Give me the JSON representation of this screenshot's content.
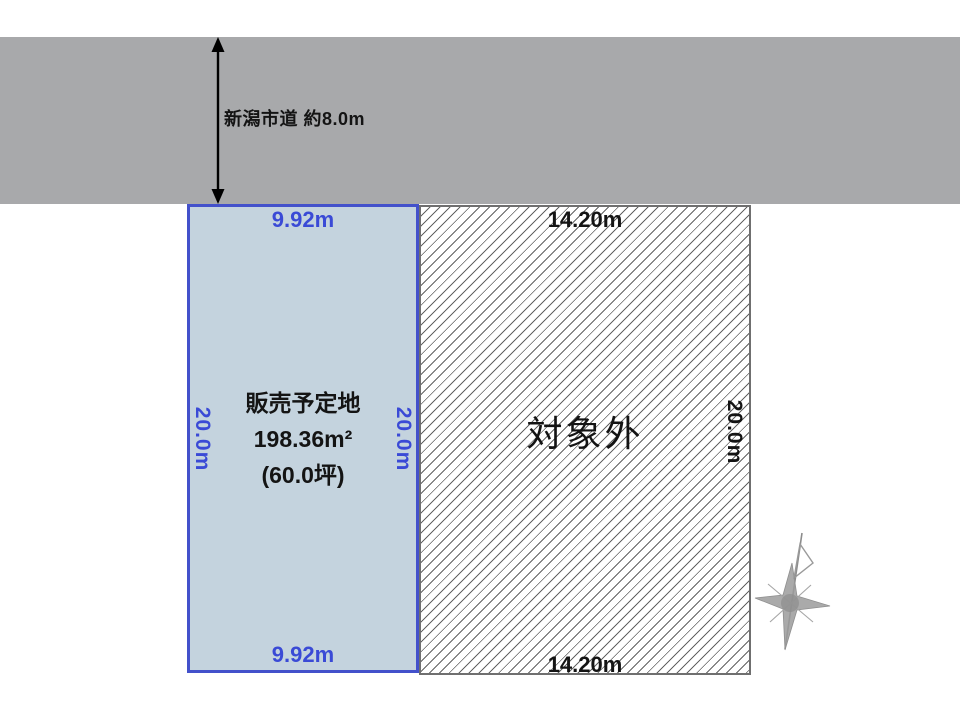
{
  "diagram": {
    "road": {
      "label": "新潟市道 約8.0m"
    },
    "sale_plot": {
      "name": "販売予定地",
      "area_sqm": "198.36m²",
      "area_tsubo": "(60.0坪)",
      "width_top": "9.92m",
      "width_bottom": "9.92m",
      "depth_left": "20.0m",
      "depth_right": "20.0m"
    },
    "excluded_plot": {
      "label": "対象外",
      "width_top": "14.20m",
      "width_bottom": "14.20m",
      "depth_right": "20.0m"
    },
    "colors": {
      "road_gray": "#a8a9ab",
      "plot_fill": "#c4d3de",
      "plot_border": "#4351cb",
      "plot_text": "#3a4ad6",
      "hatch_border": "#6f6f6f",
      "text_black": "#141414"
    }
  }
}
